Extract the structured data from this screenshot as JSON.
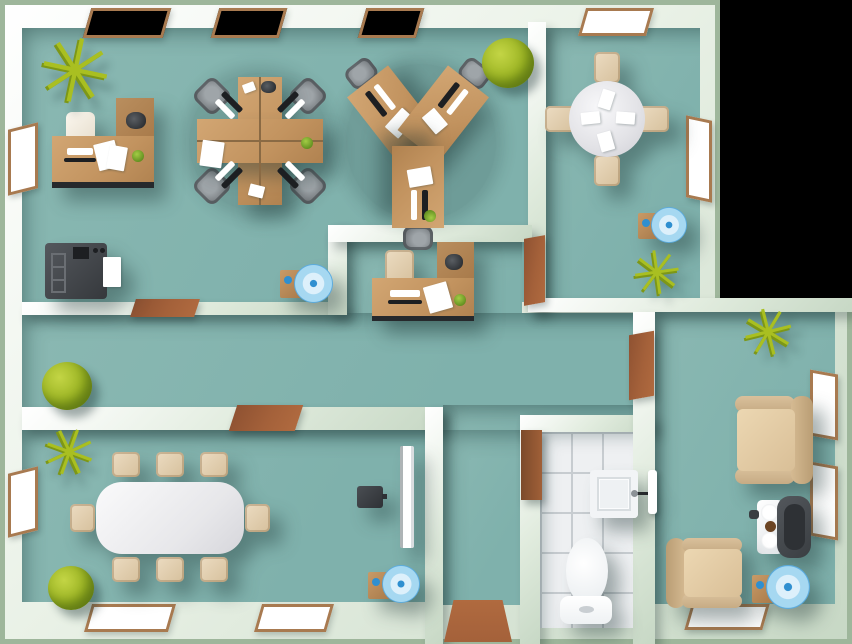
{
  "meta": {
    "title": "Office floor plan - top view illustration",
    "view": "top-down 2.5D",
    "background": "black"
  },
  "icons": {
    "palm_glyph": "✳"
  },
  "colors": {
    "outside": "#000000",
    "edge": "#9eb69b",
    "wall1": "#ffffff",
    "wall2": "#c7d8c5",
    "floor": "#7fb1ac",
    "floor2": "#8ab8b2",
    "tile": "#eef0f2",
    "tileline": "#c7ccd0",
    "frame": "#a87a50",
    "winfill": "#ffffff",
    "door": "#a4613a",
    "wood1": "#d2a673",
    "wood2": "#b08250",
    "woodside": "#a87a4a",
    "dark": "#26292c",
    "gray1": "#9fa5a9",
    "gray2": "#62676b",
    "beige1": "#ecdcc2",
    "beige2": "#d6c09c",
    "white1": "#fafafb",
    "white2": "#d6d6db",
    "blue": "#2f8fd0",
    "bluelight": "#ddf0fb",
    "green1": "#a9bf21",
    "green2": "#7d9717"
  },
  "rooms": [
    {
      "id": "open-office",
      "furniture": [
        "corner-workstation",
        "four-person-desk-cluster",
        "three-person-desk-cluster",
        "printer-copier",
        "water-cooler",
        "potted-palm",
        "bush-plant"
      ],
      "windows": 4,
      "doors": 1
    },
    {
      "id": "meeting-room",
      "furniture": [
        "round-table",
        "four-chairs",
        "water-cooler",
        "potted-palm"
      ],
      "windows": 2,
      "doors": 1
    },
    {
      "id": "reception-nook",
      "furniture": [
        "reception-desk",
        "office-chair"
      ]
    },
    {
      "id": "hallway",
      "furniture": [
        "bush-plant"
      ],
      "doors": 4
    },
    {
      "id": "conference-room",
      "furniture": [
        "conference-table",
        "eight-chairs",
        "wall-screen",
        "tv-box",
        "water-cooler",
        "potted-palm",
        "bush-plant"
      ],
      "windows": 3,
      "doors": 1
    },
    {
      "id": "entry",
      "furniture": [
        "doormat"
      ]
    },
    {
      "id": "bathroom",
      "furniture": [
        "toilet",
        "sink",
        "towel",
        "cabinet"
      ],
      "floor": "tile"
    },
    {
      "id": "lounge",
      "furniture": [
        "armchair-left",
        "armchair-right",
        "coffee-machine",
        "water-cooler",
        "potted-palm"
      ],
      "windows": 3,
      "doors": 1
    }
  ]
}
